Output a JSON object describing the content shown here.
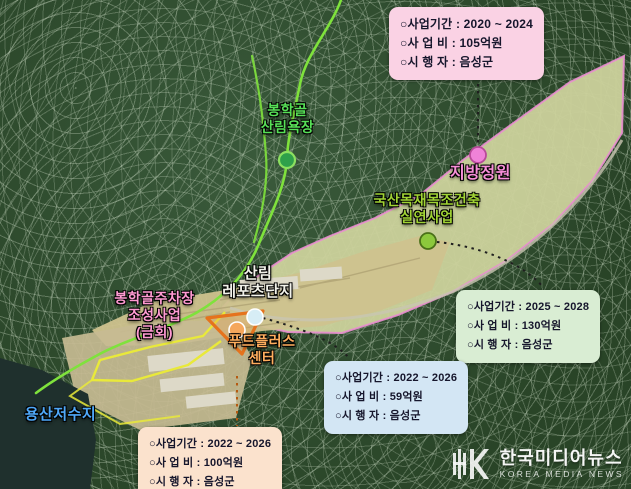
{
  "colors": {
    "field_tan": "#cfc28e",
    "valley_green": "#ccd29c",
    "facility_tan": "#c7bb93",
    "water": "#1f302d",
    "project_outline_pink": "#ea8fd0",
    "trail_green": "#7fe23c",
    "boundary_yellow": "#e9e93a",
    "triangle_orange": "#e5731d",
    "road_gray": "#c9c5b2",
    "connector_dark": "#1f1f1f",
    "connector_orange": "#b55a12",
    "marker_forest": "#2fa04a",
    "marker_forest_rim": "#8ce060",
    "marker_garden": "#ef82d8",
    "marker_garden_rim": "#b84a9a",
    "marker_timber": "#8cc83c",
    "marker_timber_rim": "#4a7018",
    "marker_leports": "#d7edf5",
    "marker_foodplus": "#f5a75c",
    "building_light": "#ddd9c8"
  },
  "labels": {
    "forest_bath": {
      "line1": "봉학골",
      "line2": "산림욕장",
      "color": "#57e057"
    },
    "provincial_garden": {
      "line1": "지방정원",
      "color": "#f78fd8"
    },
    "timber": {
      "line1": "국산목재목조건축",
      "line2": "실연사업",
      "color": "#a0d334"
    },
    "leports": {
      "line1": "산림",
      "line2": "레포츠단지",
      "color": "#f2f2ea"
    },
    "parking": {
      "line1": "봉학골주차장",
      "line2": "조성사업",
      "line3": "(금회)",
      "color": "#ff9ad2"
    },
    "foodplus": {
      "line1": "푸드플러스",
      "line2": "센터",
      "color": "#ffae5e"
    },
    "reservoir": {
      "line1": "용산저수지",
      "color": "#4fa8f8"
    }
  },
  "info_boxes": {
    "garden": {
      "period": "○사업기간 : 2020 ~ 2024",
      "budget": "○사 업 비 : 105억원",
      "agency": "○시 행 자 : 음성군",
      "bg": "#fad2e4"
    },
    "timber": {
      "period": "○사업기간 : 2025 ~ 2028",
      "budget": "○사 업 비 : 130억원",
      "agency": "○시 행 자 : 음성군",
      "bg": "#d9edd3"
    },
    "leports": {
      "period": "○사업기간 : 2022 ~ 2026",
      "budget": "○사 업 비 : 59억원",
      "agency": "○시 행 자 : 음성군",
      "bg": "#d3e6f4"
    },
    "foodplus": {
      "period": "○사업기간 : 2022 ~ 2026",
      "budget": "○사 업 비 : 100억원",
      "agency": "○시 행 자 : 음성군",
      "bg": "#fbe2cd"
    }
  },
  "watermark": {
    "title": "한국미디어뉴스",
    "subtitle": "KOREA MEDIA NEWS"
  }
}
